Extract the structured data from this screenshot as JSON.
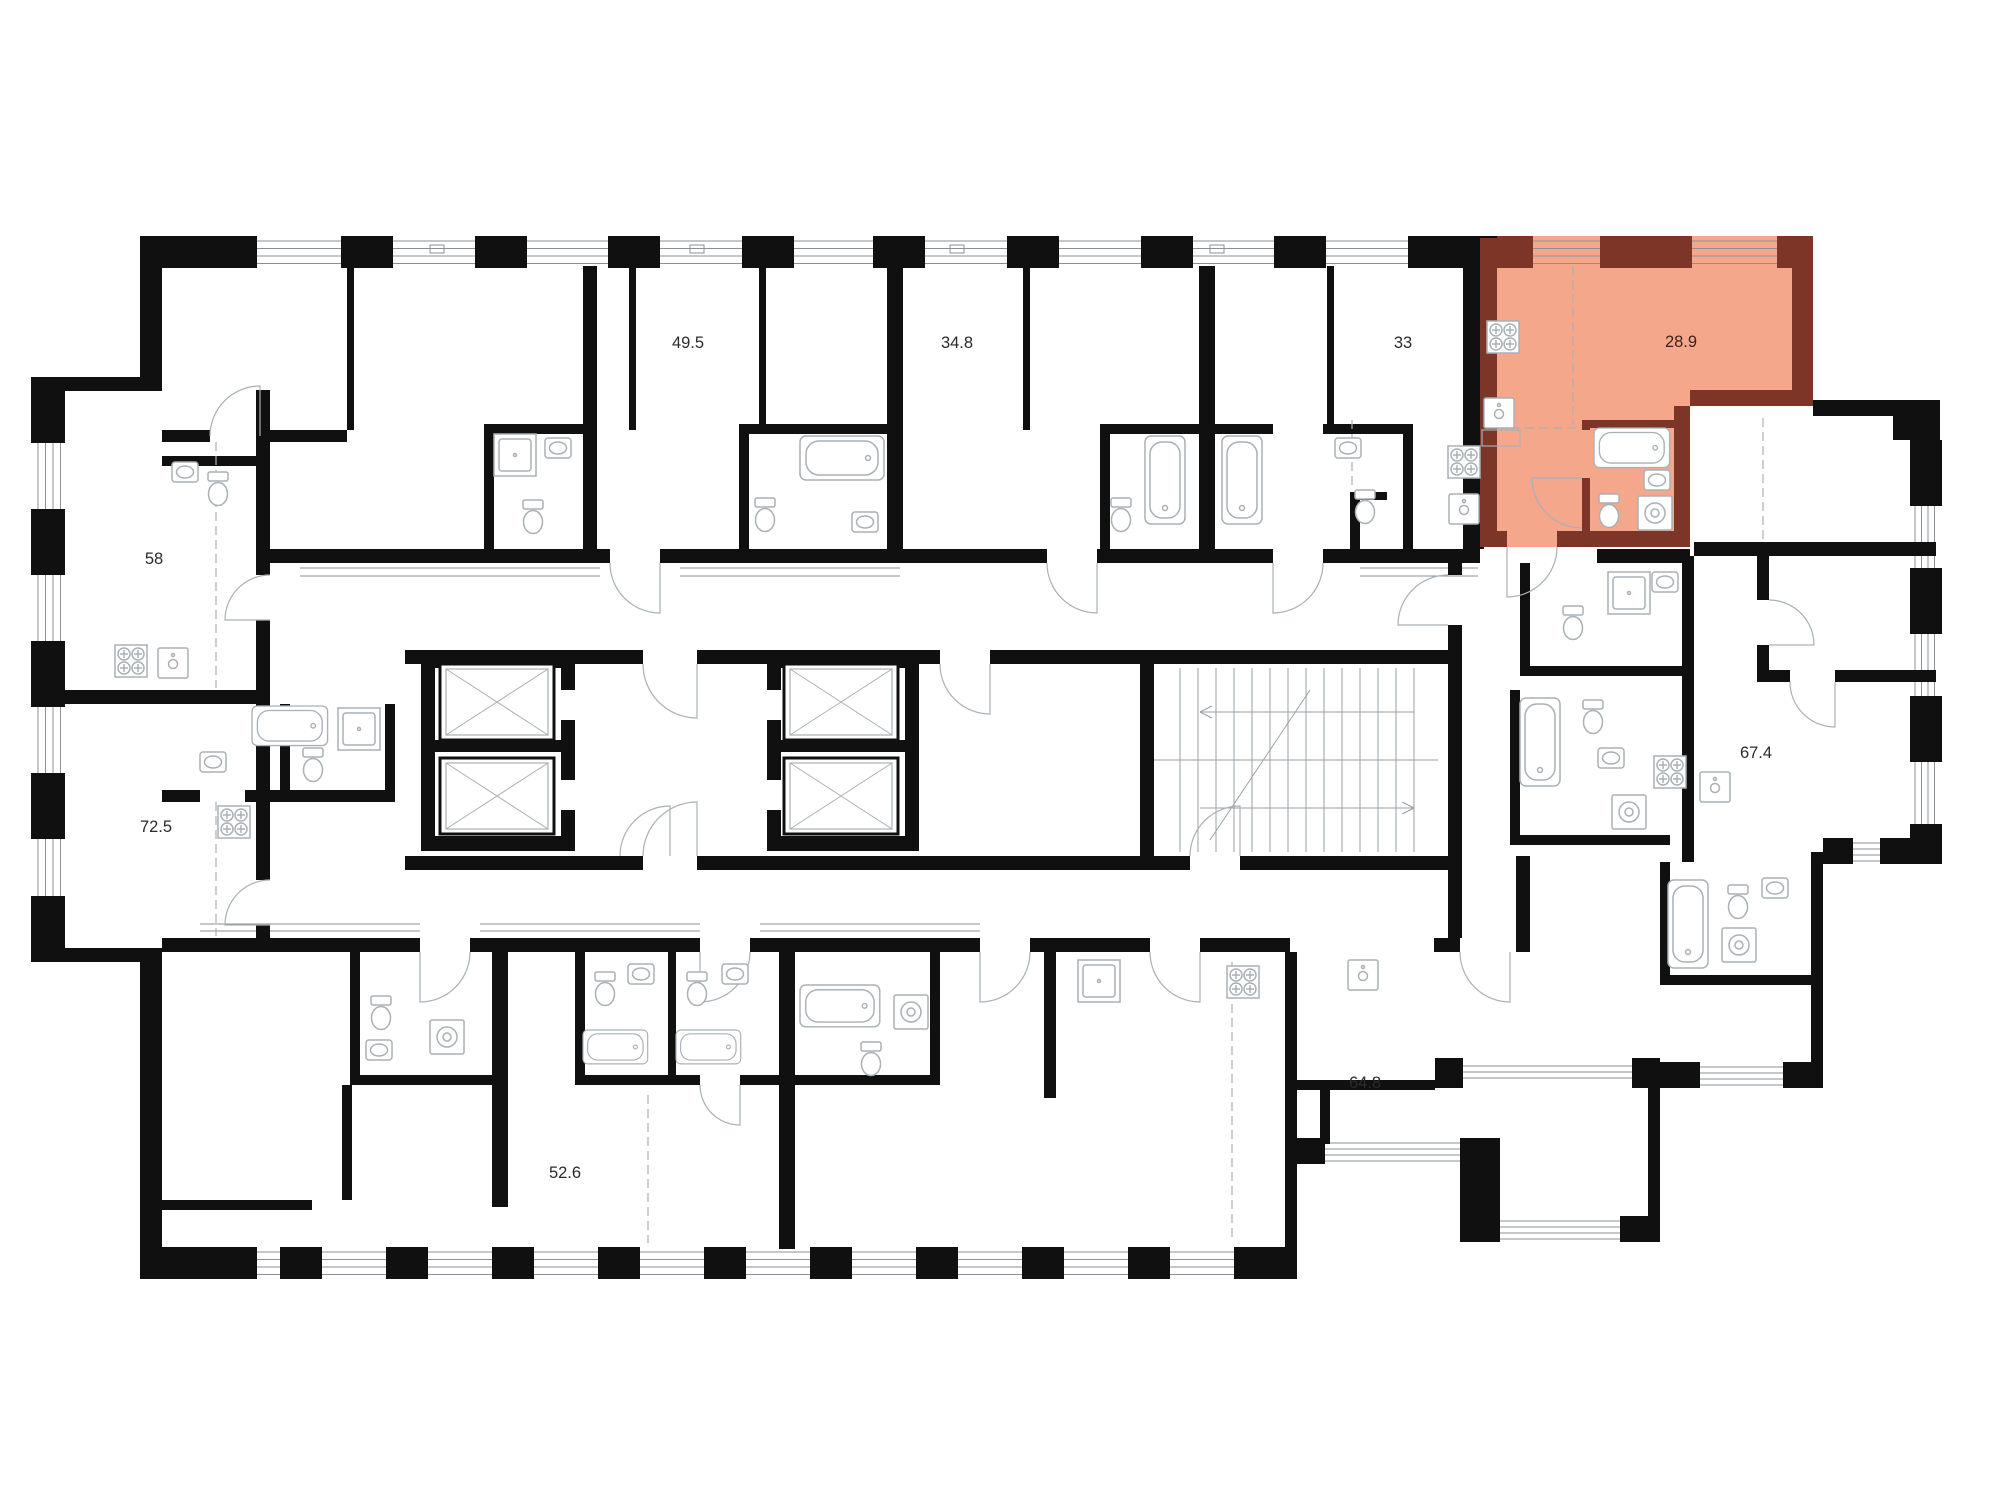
{
  "canvas": {
    "width": 2000,
    "height": 1512
  },
  "plan": {
    "type": "residential-floor-plan",
    "highlighted_unit": "28.9"
  },
  "colors": {
    "background": "#ffffff",
    "walls": "#101010",
    "thin_lines": "#a9b0b6",
    "window_lines": "#8a9096",
    "highlight_fill": "#f5a78c",
    "highlight_wall": "#7c3526",
    "highlight_label": "#40221a",
    "label_text": "#2b2b2b"
  },
  "apartments": [
    {
      "id": "unit-49.5",
      "area_label": "49.5",
      "highlighted": false
    },
    {
      "id": "unit-34.8",
      "area_label": "34.8",
      "highlighted": false
    },
    {
      "id": "unit-33",
      "area_label": "33",
      "highlighted": false
    },
    {
      "id": "unit-28.9",
      "area_label": "28.9",
      "highlighted": true
    },
    {
      "id": "unit-58",
      "area_label": "58",
      "highlighted": false
    },
    {
      "id": "unit-72.5",
      "area_label": "72.5",
      "highlighted": false
    },
    {
      "id": "unit-67.4",
      "area_label": "67.4",
      "highlighted": false
    },
    {
      "id": "unit-64.8",
      "area_label": "64.8",
      "highlighted": false
    },
    {
      "id": "unit-52.6",
      "area_label": "52.6",
      "highlighted": false
    }
  ],
  "icons": {
    "bathtub-icon": "rounded rectangle with inner basin outline and drain dot",
    "toilet-icon": "tank rectangle with bowl ellipse",
    "sink-icon": "small rectangle with oval basin",
    "stove-icon": "square with four crossed burners",
    "kitchen-sink-icon": "square with faucet circle",
    "shower-icon": "square with inner pan and drain dot",
    "washer-icon": "square with drum circles",
    "elevator-x-icon": "shaft rectangle with X diagonals",
    "stairs-icon": "treads with direction arrows",
    "door-arc-icon": "quarter-circle swing arc",
    "window-band-icon": "parallel glazing lines with black pillars"
  }
}
